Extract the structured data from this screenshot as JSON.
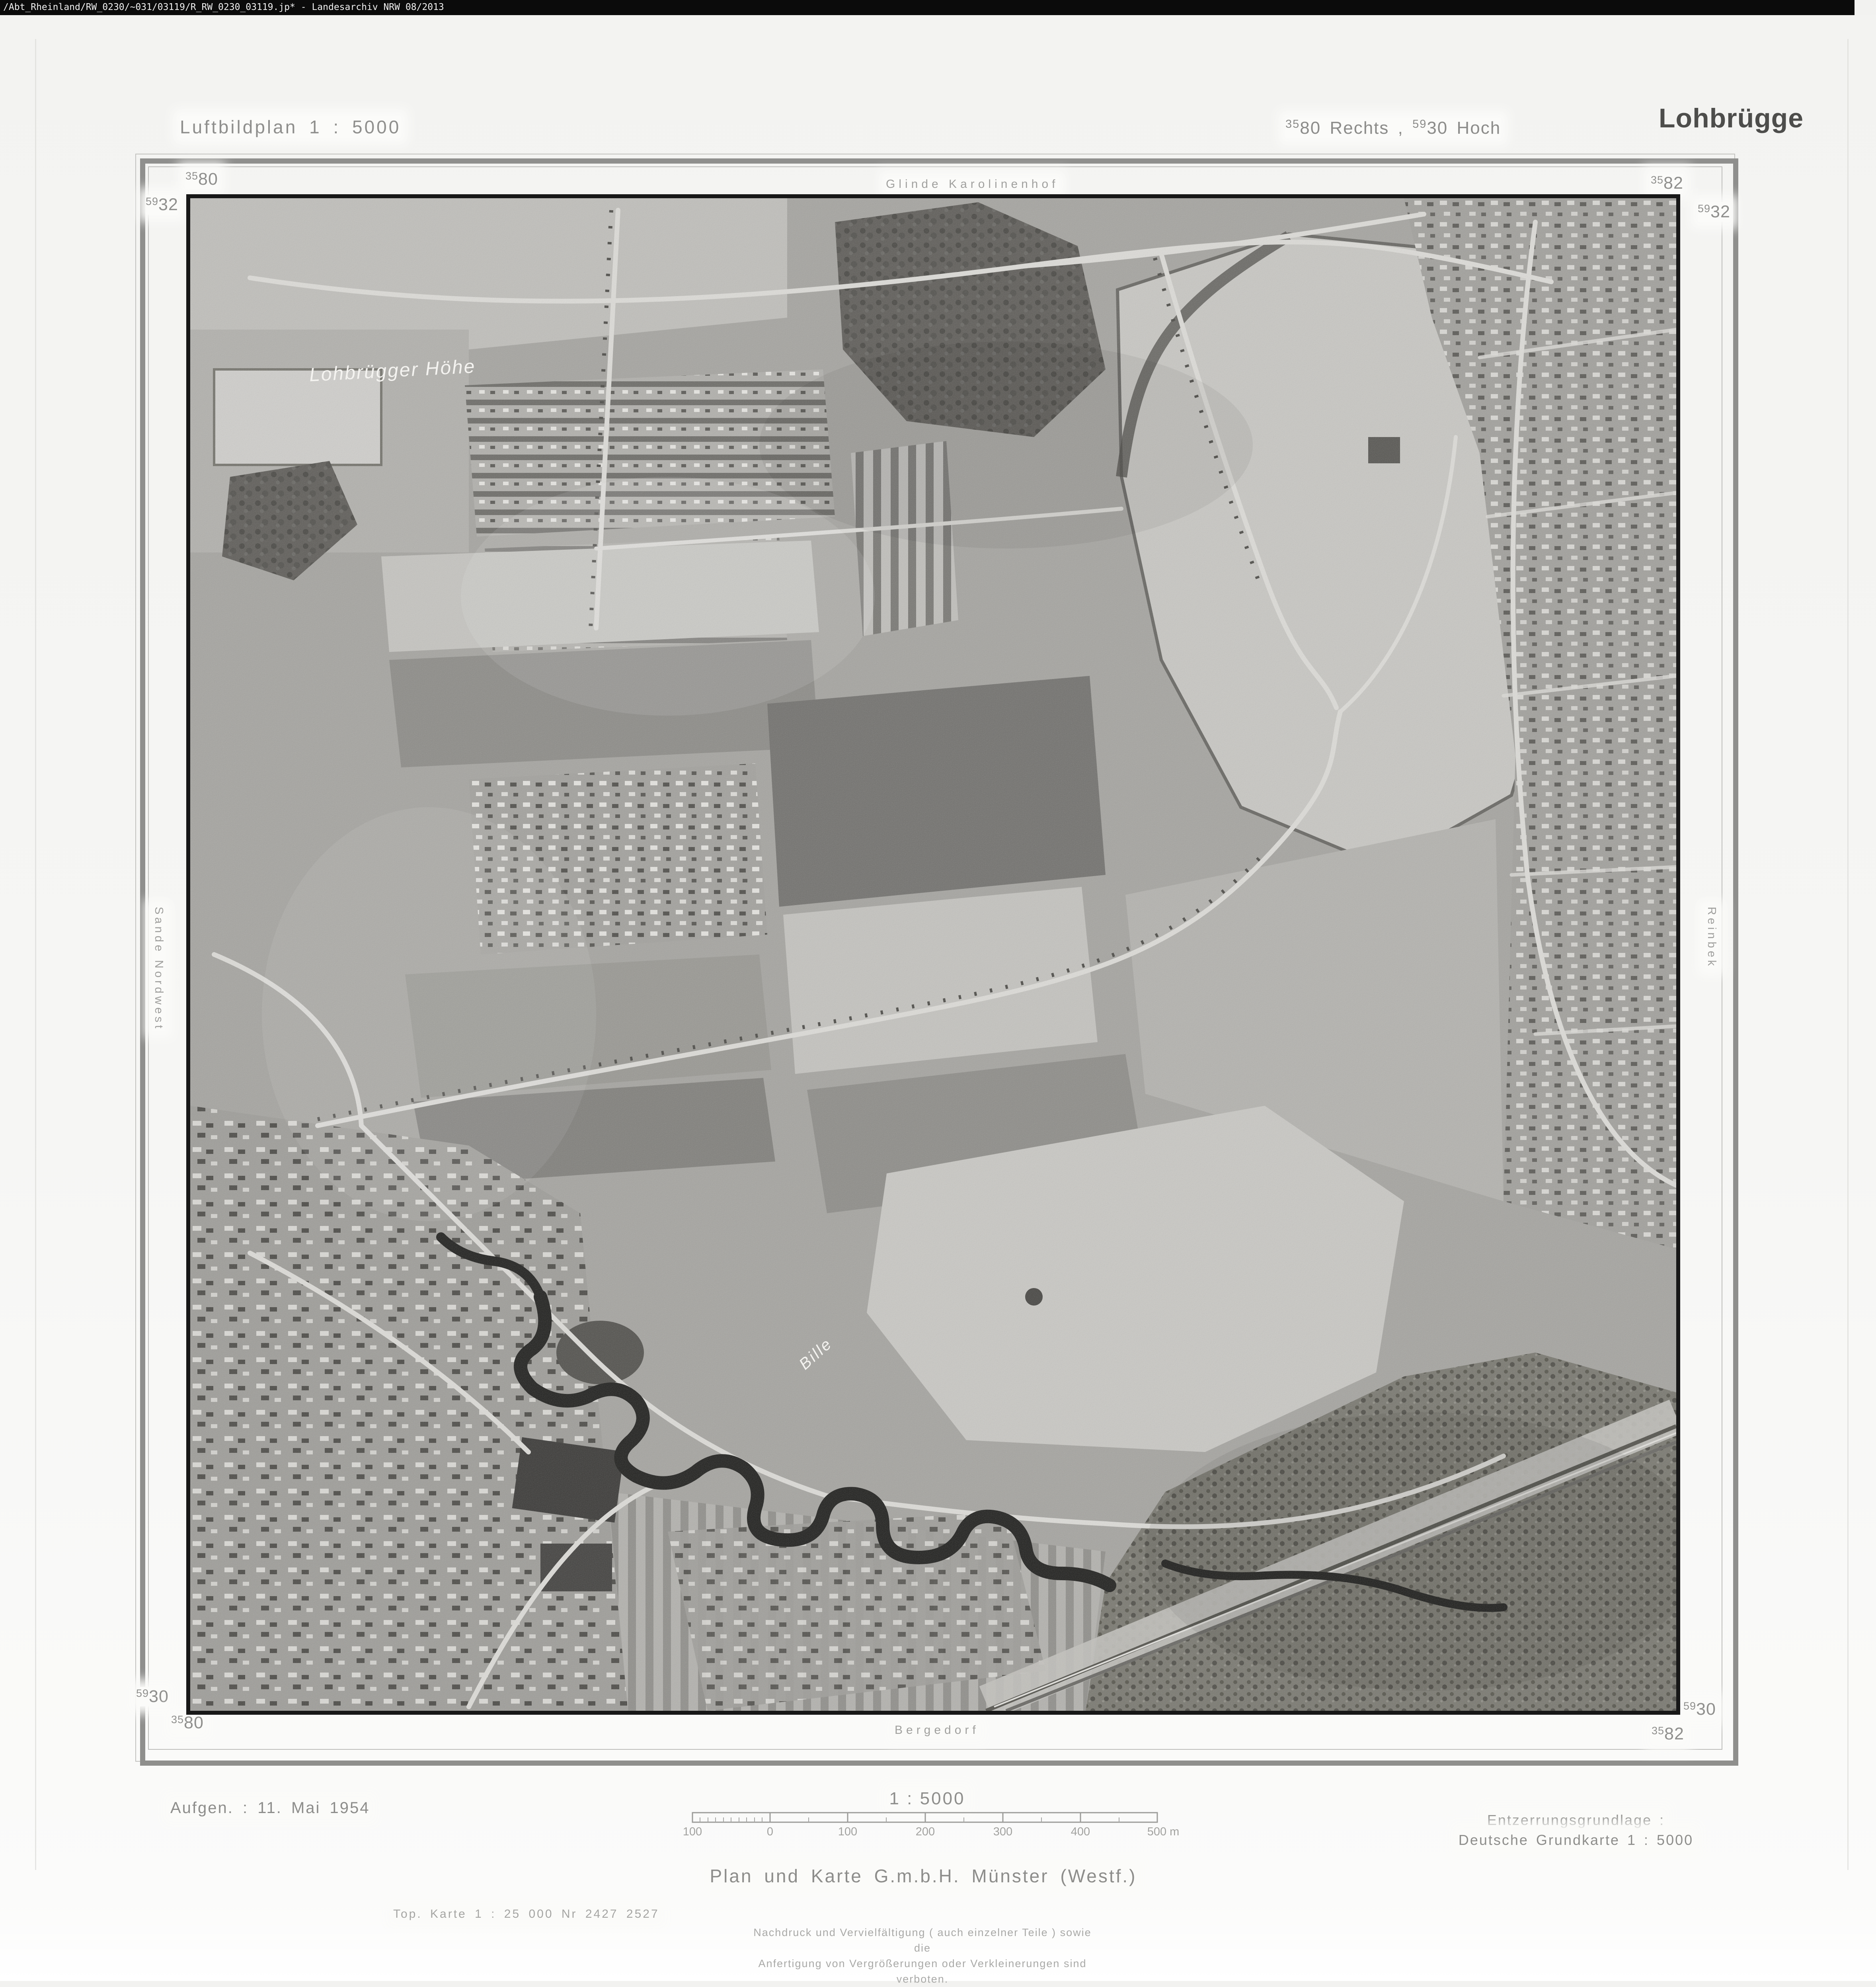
{
  "viewer_bar": {
    "text": "/Abt_Rheinland/RW_0230/~031/03119/R_RW_0230_03119.jp* -  Landesarchiv NRW  08/2013"
  },
  "header": {
    "plan_title": "Luftbildplan 1 : 5000",
    "coords": {
      "sup1": "35",
      "main1": "80",
      "mid": " Rechts , ",
      "sup2": "59",
      "main2": "30",
      "end": " Hoch"
    },
    "sheet_name": "Lohbrügge"
  },
  "grid": {
    "tl_top": {
      "sup": "35",
      "main": "80"
    },
    "tl_side": {
      "sup": "59",
      "main": "32"
    },
    "tr_top": {
      "sup": "35",
      "main": "82"
    },
    "tr_side": {
      "sup": "59",
      "main": "32"
    },
    "bl_side": {
      "sup": "59",
      "main": "30"
    },
    "bl_bottom": {
      "sup": "35",
      "main": "80"
    },
    "br_side": {
      "sup": "59",
      "main": "30"
    },
    "br_bottom": {
      "sup": "35",
      "main": "82"
    }
  },
  "edges": {
    "top": "Glinde Karolinenhof",
    "bottom": "Bergedorf",
    "left": "Sande Nordwest",
    "right": "Reinbek"
  },
  "photo": {
    "hill_label": "Lohbrügger Höhe",
    "river_label": "Bille"
  },
  "footer": {
    "aufgen": "Aufgen. : 11. Mai 1954",
    "scale_title": "1 : 5000",
    "ticks": [
      "100",
      "0",
      "100",
      "200",
      "300",
      "400",
      "500 m"
    ],
    "entzerrung1": "Entzerrungsgrundlage :",
    "entzerrung2": "Deutsche Grundkarte 1 : 5000",
    "publisher": "Plan und Karte G.m.b.H.  Münster (Westf.)",
    "top_karte": "Top. Karte 1 : 25 000   Nr   2427   2527",
    "nachdruck1": "Nachdruck und Vervielfältigung ( auch einzelner Teile ) sowie die",
    "nachdruck2": "Anfertigung von Vergrößerungen oder Verkleinerungen sind verboten."
  }
}
